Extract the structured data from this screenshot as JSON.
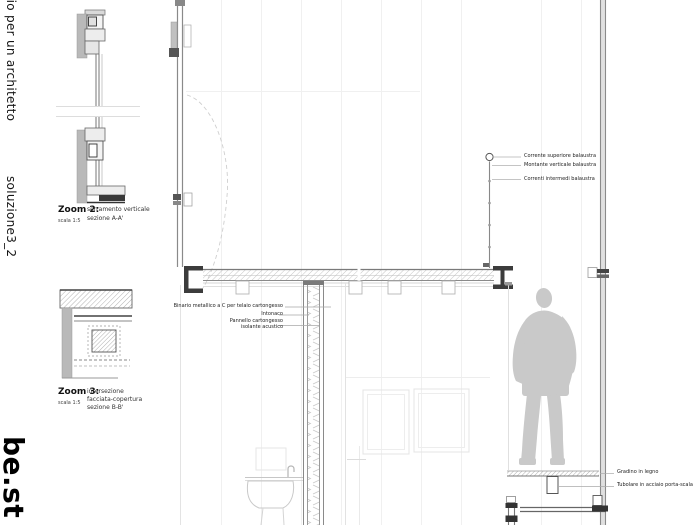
{
  "sheet": {
    "title_vertical": "lio per un architetto",
    "subtitle_vertical": "soluzione3_2",
    "logo": "be.st a"
  },
  "zoom2": {
    "label": "Zoom 2:",
    "scale": "scala 1:5",
    "desc1": "serramento verticale",
    "desc2": "sezione A-A'"
  },
  "zoom3": {
    "label": "Zoom 3:",
    "scale": "scala 1:5",
    "desc1": "intersezione",
    "desc2": "facciata-copertura",
    "desc3": "sezione B-B'"
  },
  "annotations": {
    "balustrade": [
      "Corrente superiore balaustra",
      "Montante verticale balaustra",
      "Correnti intermedi balaustra"
    ],
    "partition": [
      "Binario metallico a C per telaio cartongesso",
      "Intonaco",
      "Pannello cartongesso",
      "isolante acustico"
    ],
    "stair": [
      "Gradino in legno",
      "Tubolare in acciaio porta-scala"
    ]
  },
  "colors": {
    "background": "#ffffff",
    "line_dark": "#3c3c3c",
    "line_mid": "#8a8a8a",
    "line_light": "#cccccc",
    "wall_fill": "#b9b9b9",
    "silhouette": "#c9c9c9",
    "text": "#1a1a1a"
  }
}
